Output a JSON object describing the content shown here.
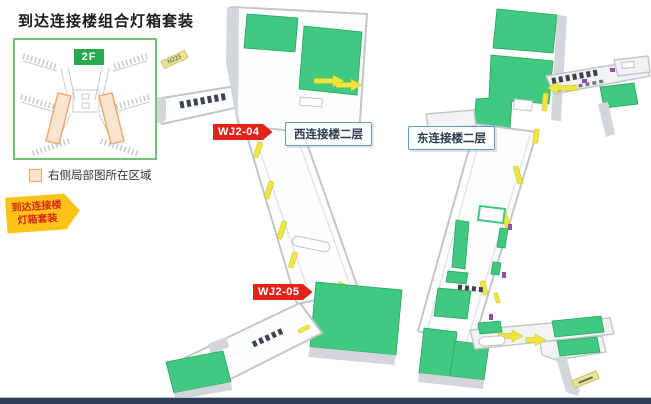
{
  "page": {
    "title": "到达连接楼组合灯箱套装"
  },
  "inset": {
    "floor_badge": "2F",
    "legend_label": "右侧局部图所在区域"
  },
  "callout": {
    "line1": "到达连接楼",
    "line2": "灯箱套装"
  },
  "plan": {
    "west": {
      "code_top": "WJ2-04",
      "code_bottom": "WJ2-05",
      "name": "西连接楼二层",
      "gate_tag": "N223"
    },
    "east": {
      "name": "东连接楼二层",
      "gate_tag": ""
    }
  },
  "colors": {
    "accent_red": "#e2231a",
    "callout_yellow": "#ffc216",
    "badge_green": "#28a94c",
    "plan_green": "#40c980",
    "lightbox_yellow": "#efe63e",
    "highlight_orange_border": "#efa763",
    "highlight_orange_fill": "#fbe4cf",
    "label_border_blue": "#5b9bd5",
    "inset_border_green": "#74c276",
    "footer_navy": "#2f3e58"
  }
}
